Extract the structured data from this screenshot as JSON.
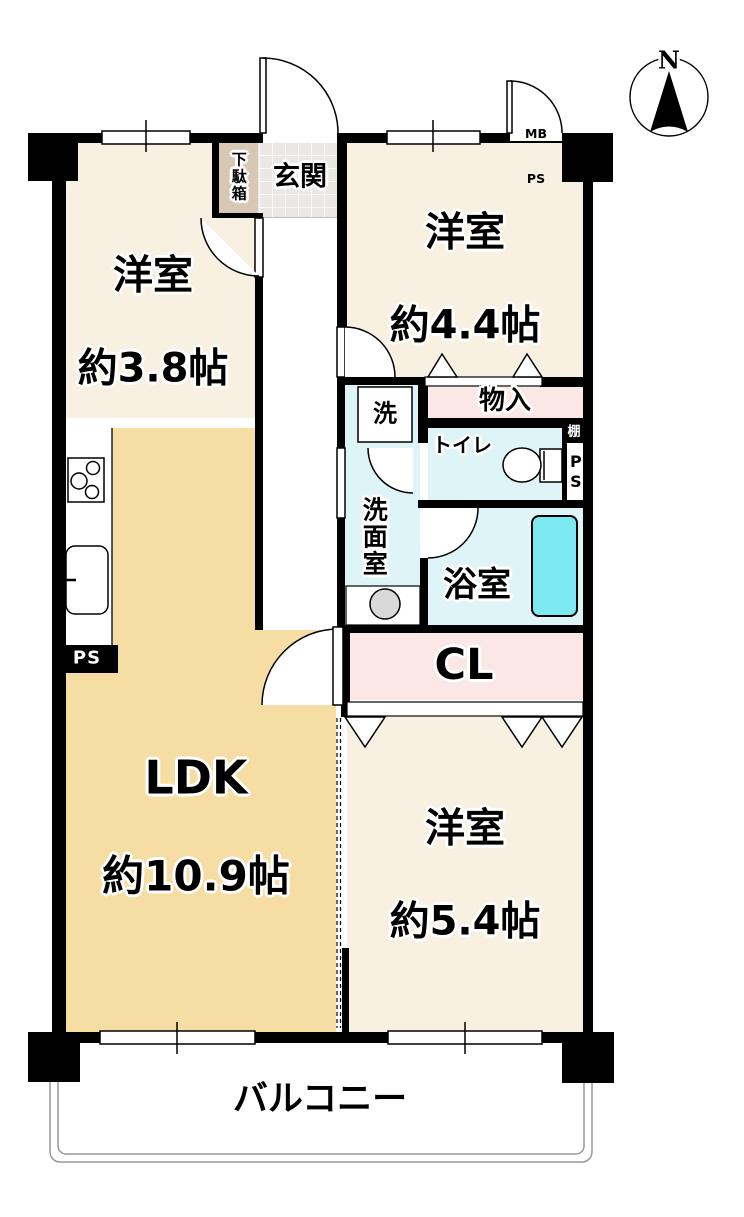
{
  "compass": {
    "north_label": "N"
  },
  "labels": {
    "genkan": "玄関",
    "getabako": "下駄箱",
    "room_38": {
      "name": "洋室",
      "area": "約3.8帖"
    },
    "room_44": {
      "name": "洋室",
      "area": "約4.4帖"
    },
    "room_54": {
      "name": "洋室",
      "area": "約5.4帖"
    },
    "ldk": {
      "name": "LDK",
      "area": "約10.9帖"
    },
    "washer": "洗",
    "washroom": "洗面室",
    "storage": "物入",
    "toilet": "トイレ",
    "shelf": "棚",
    "ps_right": "PS",
    "bath": "浴室",
    "closet": "CL",
    "meter_box": {
      "line1": "MB",
      "line2": "PS"
    },
    "ps_left": "PS",
    "balcony": "バルコニー"
  },
  "colors": {
    "wall": "#000000",
    "western_room": "#f8f1e1",
    "ldk": "#f5dda4",
    "wet_area": "#dff4f6",
    "storage_pink": "#fce7e7",
    "bathtub": "#7ce9f1",
    "genkan_tile": "#e9e8e5",
    "getabako": "#d7c7b4",
    "basin": "#d9d9d9"
  }
}
